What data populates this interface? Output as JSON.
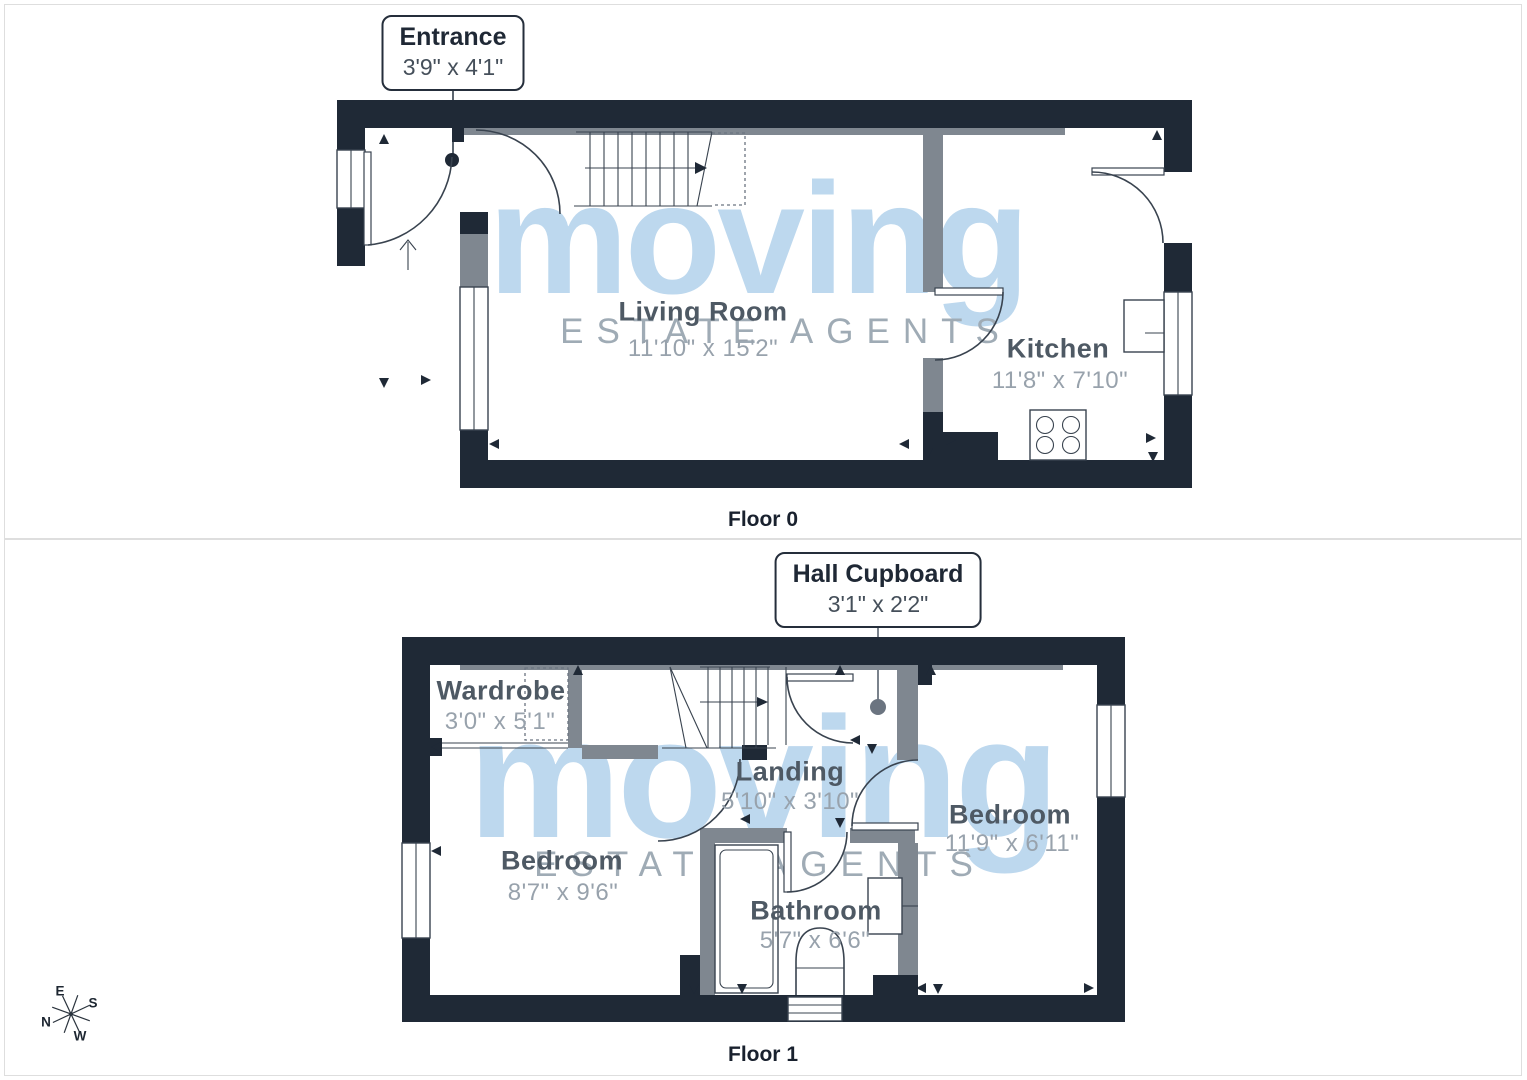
{
  "colors": {
    "wall_dark": "#1f2936",
    "wall_gray": "#7f8790",
    "line": "#39434f",
    "watermark_blue": "#bdd8ee",
    "watermark_gray": "#9fabb5",
    "room_name": "#4e5964",
    "room_dims": "#98a2ac",
    "callout_border": "#252e3b",
    "callout_title": "#1f2835",
    "callout_dims": "#454f5a",
    "caption": "#19212e",
    "panel_border": "#dedede",
    "dot_gray": "#6b7480"
  },
  "watermark": {
    "brand": "moving",
    "tagline": "ESTATE AGENTS"
  },
  "compass": {
    "e": "E",
    "s": "S",
    "n": "N",
    "w": "W"
  },
  "floor0": {
    "caption": "Floor 0",
    "callout": {
      "title": "Entrance",
      "dims": "3'9\" x 4'1\""
    },
    "rooms": {
      "living": {
        "name": "Living Room",
        "dims": "11'10\" x 15'2\""
      },
      "kitchen": {
        "name": "Kitchen",
        "dims": "11'8\" x 7'10\""
      }
    }
  },
  "floor1": {
    "caption": "Floor 1",
    "callout": {
      "title": "Hall Cupboard",
      "dims": "3'1\" x 2'2\""
    },
    "rooms": {
      "wardrobe": {
        "name": "Wardrobe",
        "dims": "3'0\" x 5'1\""
      },
      "landing": {
        "name": "Landing",
        "dims": "5'10\" x 3'10\""
      },
      "bedroom1": {
        "name": "Bedroom",
        "dims": "8'7\" x 9'6\""
      },
      "bedroom2": {
        "name": "Bedroom",
        "dims": "11'9\" x 6'11\""
      },
      "bathroom": {
        "name": "Bathroom",
        "dims": "5'7\" x 6'6\""
      }
    }
  }
}
